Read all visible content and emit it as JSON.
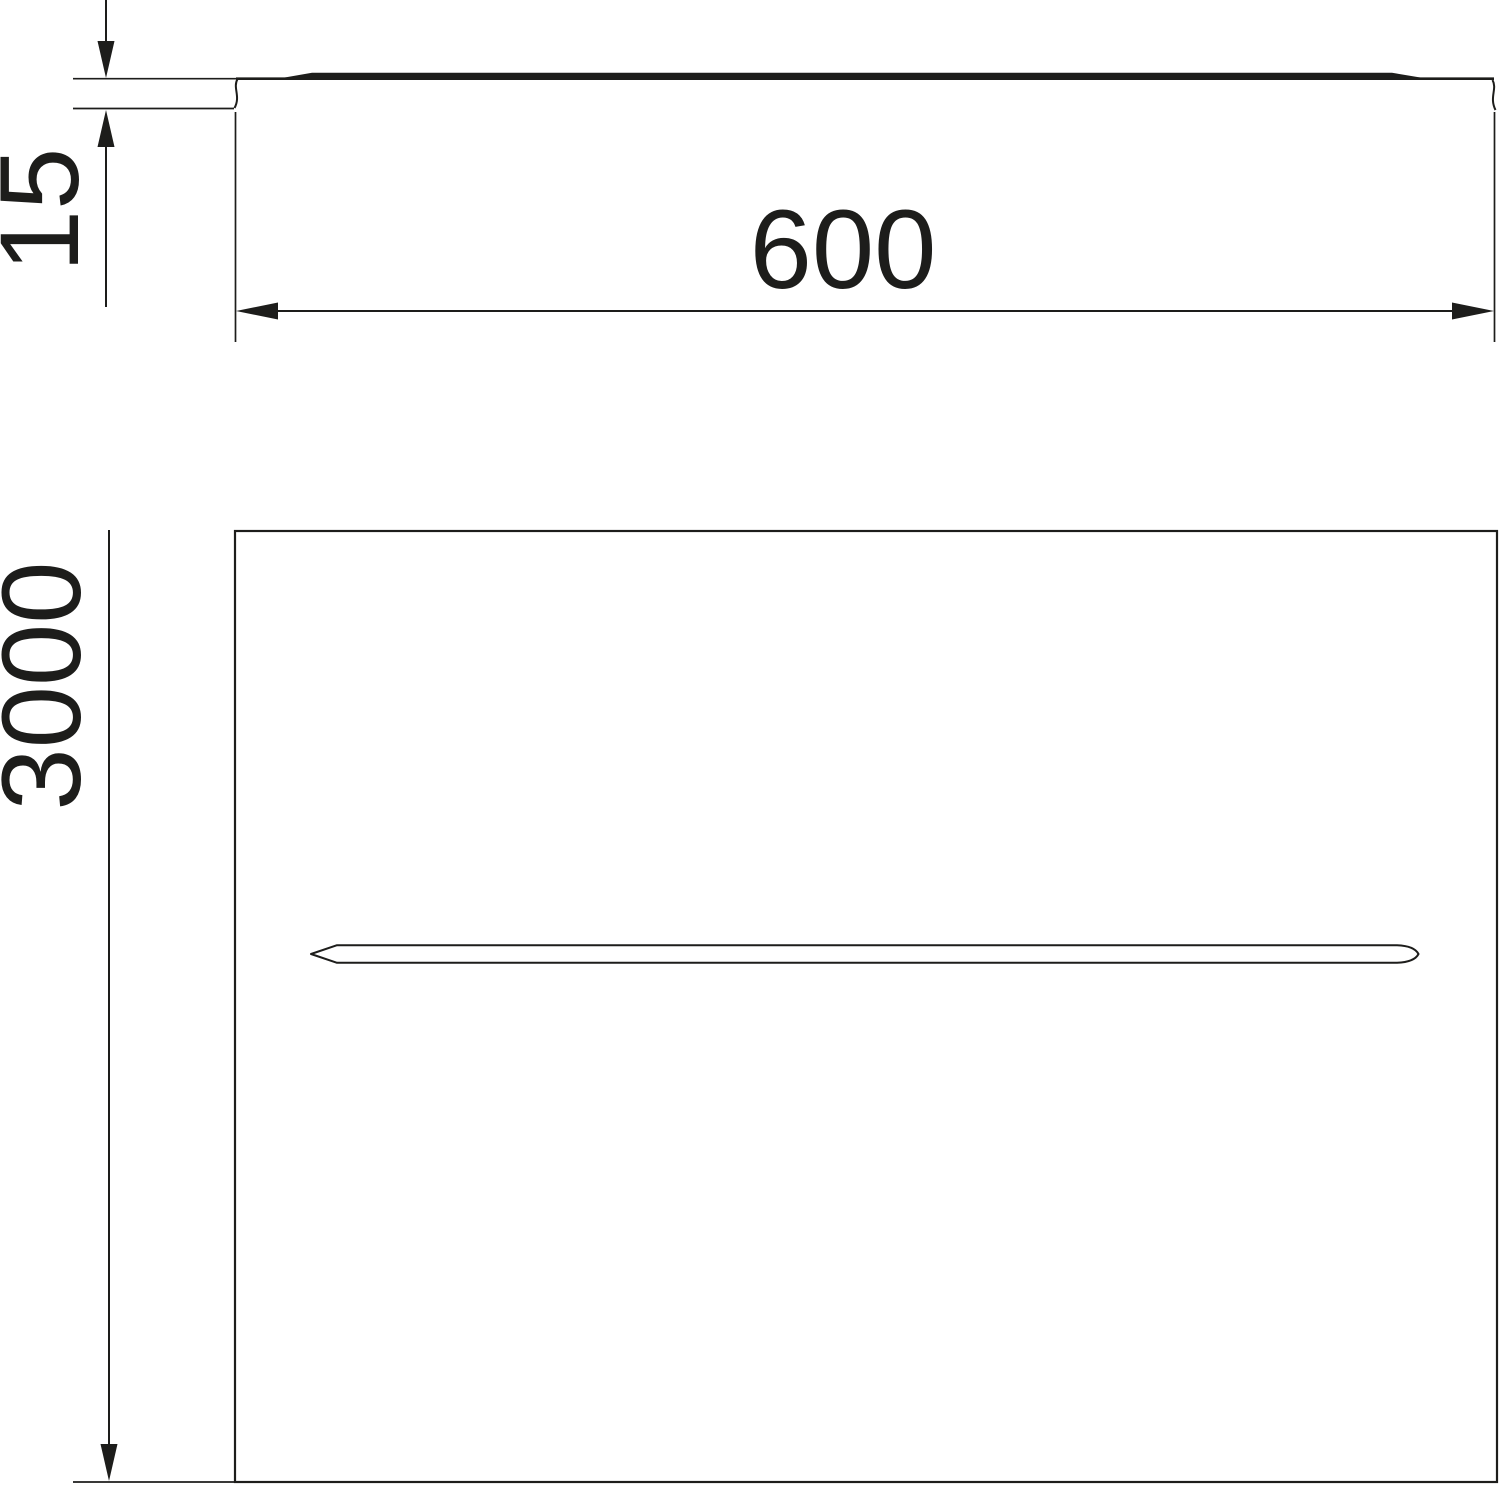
{
  "drawing": {
    "description": "Technical dimension drawing of a flat cover plate with a central longitudinal rib: side profile view on top, plan view below",
    "background_color": "#ffffff",
    "line_color": "#1d1d1b",
    "side_view": {
      "dim_height_label": "15",
      "dim_width_label": "600"
    },
    "plan_view": {
      "dim_length_label": "3000"
    }
  }
}
